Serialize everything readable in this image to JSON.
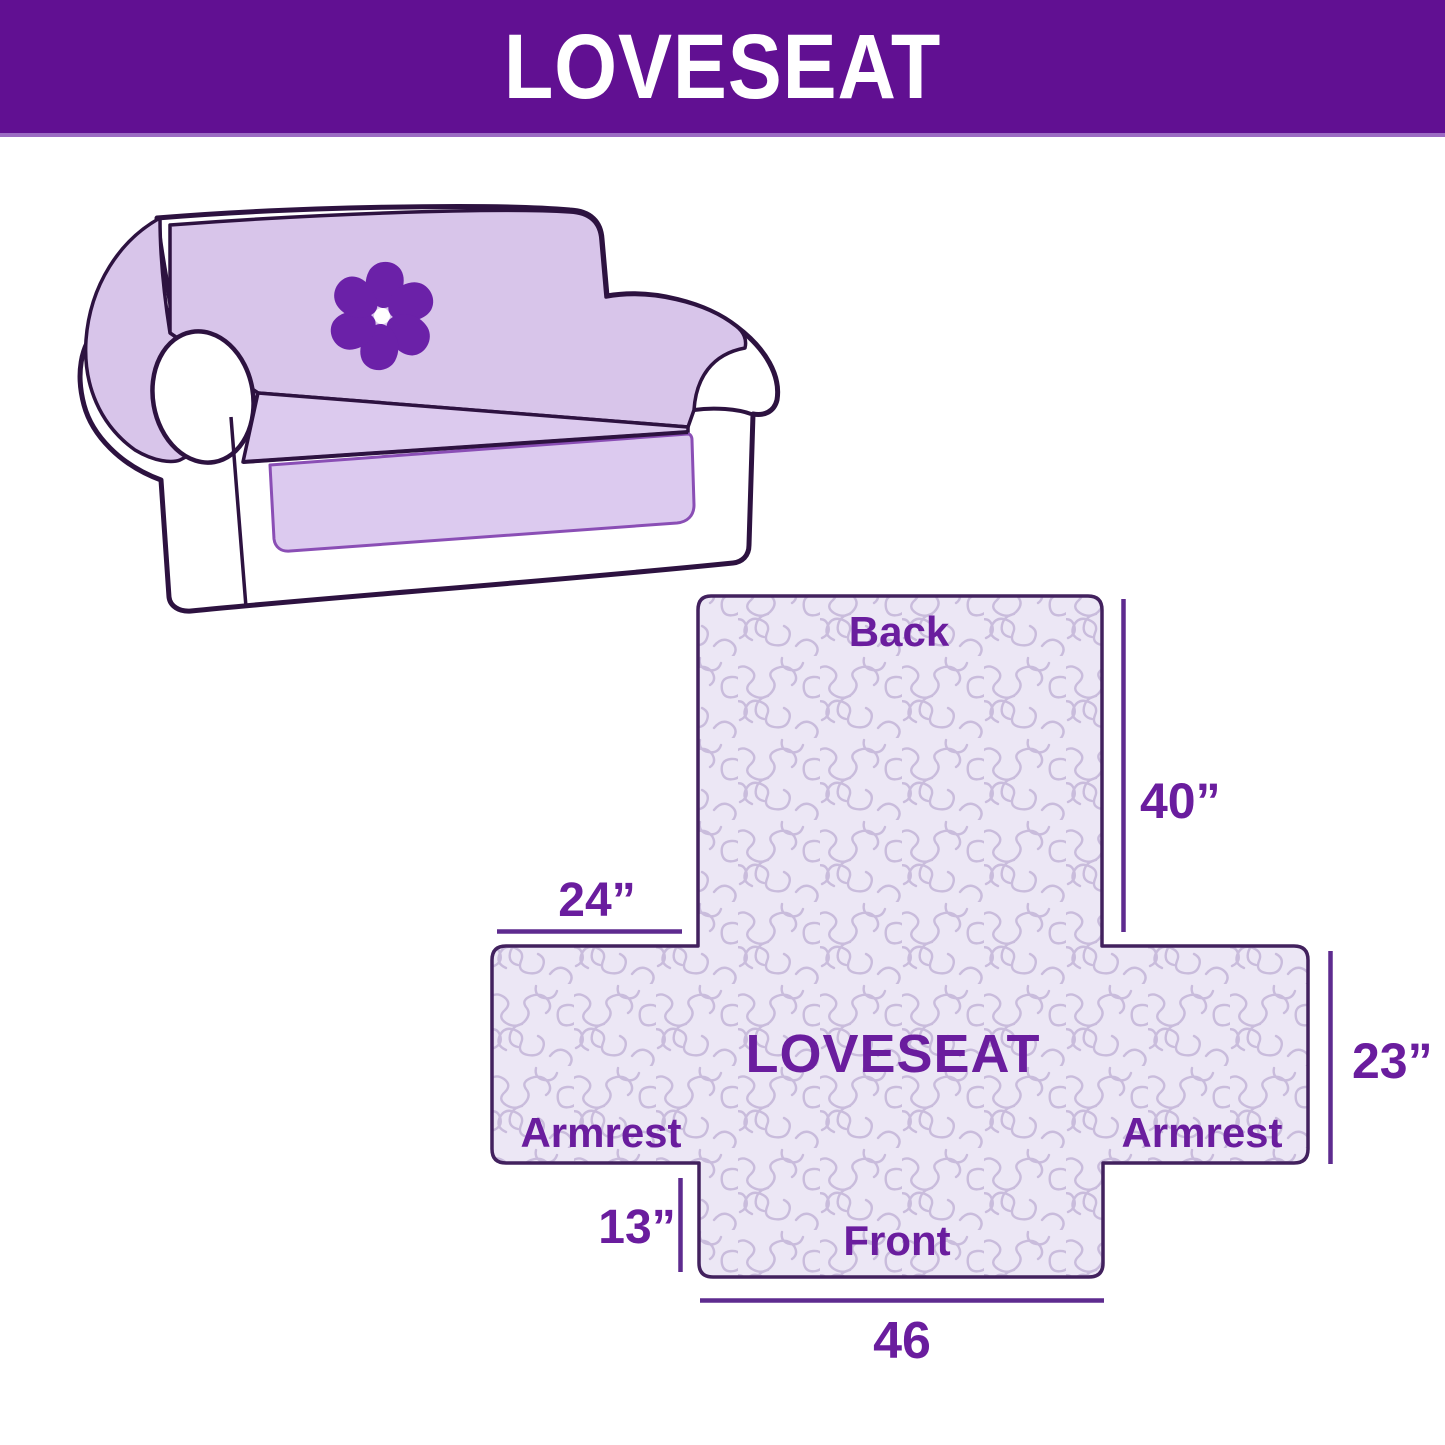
{
  "header": {
    "title": "LOVESEAT"
  },
  "illustration": {
    "description": "loveseat sofa with quilted slipcover",
    "logo": "pinwheel-icon"
  },
  "diagram": {
    "back_label": "Back",
    "center_label": "LOVESEAT",
    "front_label": "Front",
    "armrest_left_label": "Armrest",
    "armrest_right_label": "Armrest",
    "dim_back_height": "40”",
    "dim_back_width": "24”",
    "dim_side_depth": "23”",
    "dim_front_drop": "13”",
    "dim_front_width": "46"
  },
  "colors": {
    "header_bg": "#611092",
    "header_text": "#ffffff",
    "label_purple": "#6a1d9e",
    "dimension_line": "#5e2b8f",
    "shape_fill": "#ece7f5",
    "squiggle": "#c9bcdc",
    "shape_outline": "#42215e",
    "sofa_ink": "#2d1240",
    "cover_lavender": "#d8c5ea",
    "seat_lavender": "#dccaee",
    "flap_border": "#8a4eb5",
    "logo_purple": "#6b21a8"
  }
}
